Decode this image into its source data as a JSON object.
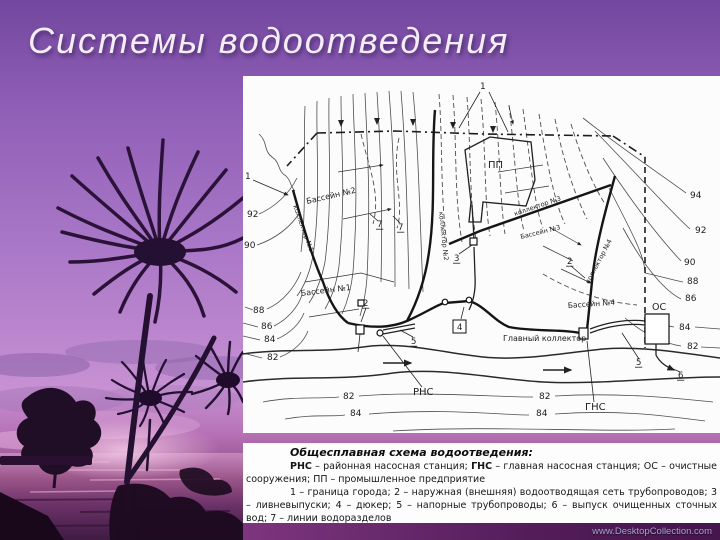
{
  "title": "Системы водоотведения",
  "watermark": "www.DesktopCollection.com",
  "caption": {
    "heading": "Общесплавная схема водоотведения:",
    "para1": [
      {
        "t": "РНС",
        "b": true
      },
      {
        "t": " – районная насосная станция; ",
        "b": false
      },
      {
        "t": "ГНС",
        "b": true
      },
      {
        "t": " – главная насосная станция; ОС – очистные сооружения; ПП – промышленное предприятие",
        "b": false
      }
    ],
    "para2": "1 – граница города; 2 – наружная (внешняя) водоотводящая сеть трубопроводов; 3 – ливневыпуски; 4 – дюкер; 5 – напорные трубопроводы; 6 – выпуск очищенных сточных вод; 7 – линии водоразделов"
  },
  "diagram": {
    "labels": [
      {
        "text": "1",
        "x": 237,
        "y": 13,
        "size": 9
      },
      {
        "text": "1",
        "x": 2,
        "y": 103,
        "size": 9
      },
      {
        "text": "ПП",
        "x": 245,
        "y": 92,
        "size": 10
      },
      {
        "text": "Бассейн №2",
        "x": 64,
        "y": 128,
        "rot": -13,
        "size": 8
      },
      {
        "text": "Бассейн №1",
        "x": 58,
        "y": 220,
        "rot": -7,
        "size": 8
      },
      {
        "text": "Бассейн №3",
        "x": 278,
        "y": 163,
        "rot": -14,
        "size": 6.5
      },
      {
        "text": "Бассейн №4",
        "x": 325,
        "y": 232,
        "rot": -4,
        "size": 7.5
      },
      {
        "text": "коллектор №1",
        "x": 50,
        "y": 130,
        "rot": 70,
        "size": 6.5
      },
      {
        "text": "коллектор №2",
        "x": 196,
        "y": 136,
        "rot": 84,
        "size": 6.5
      },
      {
        "text": "коллектор №3",
        "x": 272,
        "y": 140,
        "rot": -19,
        "size": 6.5
      },
      {
        "text": "коллектор №4",
        "x": 346,
        "y": 208,
        "rot": -62,
        "size": 6.5
      },
      {
        "text": "Главный коллектор",
        "x": 260,
        "y": 265,
        "size": 8
      },
      {
        "text": "РНС",
        "x": 170,
        "y": 319,
        "size": 10
      },
      {
        "text": "ГНС",
        "x": 342,
        "y": 334,
        "size": 10
      },
      {
        "text": "ОС",
        "x": 409,
        "y": 234,
        "size": 9.5
      },
      {
        "text": "92",
        "x": 4,
        "y": 141,
        "size": 9
      },
      {
        "text": "90",
        "x": 1,
        "y": 172,
        "size": 9
      },
      {
        "text": "88",
        "x": 10,
        "y": 237,
        "size": 9
      },
      {
        "text": "86",
        "x": 18,
        "y": 253,
        "size": 9
      },
      {
        "text": "84",
        "x": 21,
        "y": 266,
        "size": 9
      },
      {
        "text": "82",
        "x": 24,
        "y": 284,
        "size": 9
      },
      {
        "text": "94",
        "x": 447,
        "y": 122,
        "size": 9
      },
      {
        "text": "92",
        "x": 452,
        "y": 157,
        "size": 9
      },
      {
        "text": "90",
        "x": 441,
        "y": 189,
        "size": 9
      },
      {
        "text": "88",
        "x": 444,
        "y": 208,
        "size": 9
      },
      {
        "text": "86",
        "x": 442,
        "y": 225,
        "size": 9
      },
      {
        "text": "84",
        "x": 436,
        "y": 254,
        "size": 9
      },
      {
        "text": "82",
        "x": 444,
        "y": 273,
        "size": 9
      },
      {
        "text": "82",
        "x": 100,
        "y": 323,
        "size": 9
      },
      {
        "text": "84",
        "x": 107,
        "y": 340,
        "size": 9
      },
      {
        "text": "82",
        "x": 296,
        "y": 323,
        "size": 9
      },
      {
        "text": "84",
        "x": 293,
        "y": 340,
        "size": 9
      },
      {
        "text": "7",
        "x": 134,
        "y": 151,
        "size": 8.5,
        "u": true
      },
      {
        "text": "7",
        "x": 155,
        "y": 154,
        "size": 8.5,
        "u": true
      },
      {
        "text": "2",
        "x": 120,
        "y": 230,
        "size": 8.5,
        "u": true
      },
      {
        "text": "2",
        "x": 324,
        "y": 188,
        "size": 8.5,
        "u": true
      },
      {
        "text": "3",
        "x": 211,
        "y": 185,
        "size": 8.5,
        "u": true
      },
      {
        "text": "4",
        "x": 214,
        "y": 254,
        "size": 8.5
      },
      {
        "text": "5",
        "x": 168,
        "y": 268,
        "size": 8.5,
        "u": true
      },
      {
        "text": "5",
        "x": 393,
        "y": 289,
        "size": 8.5,
        "u": true
      },
      {
        "text": "6",
        "x": 435,
        "y": 302,
        "size": 8.5,
        "u": true
      }
    ]
  }
}
